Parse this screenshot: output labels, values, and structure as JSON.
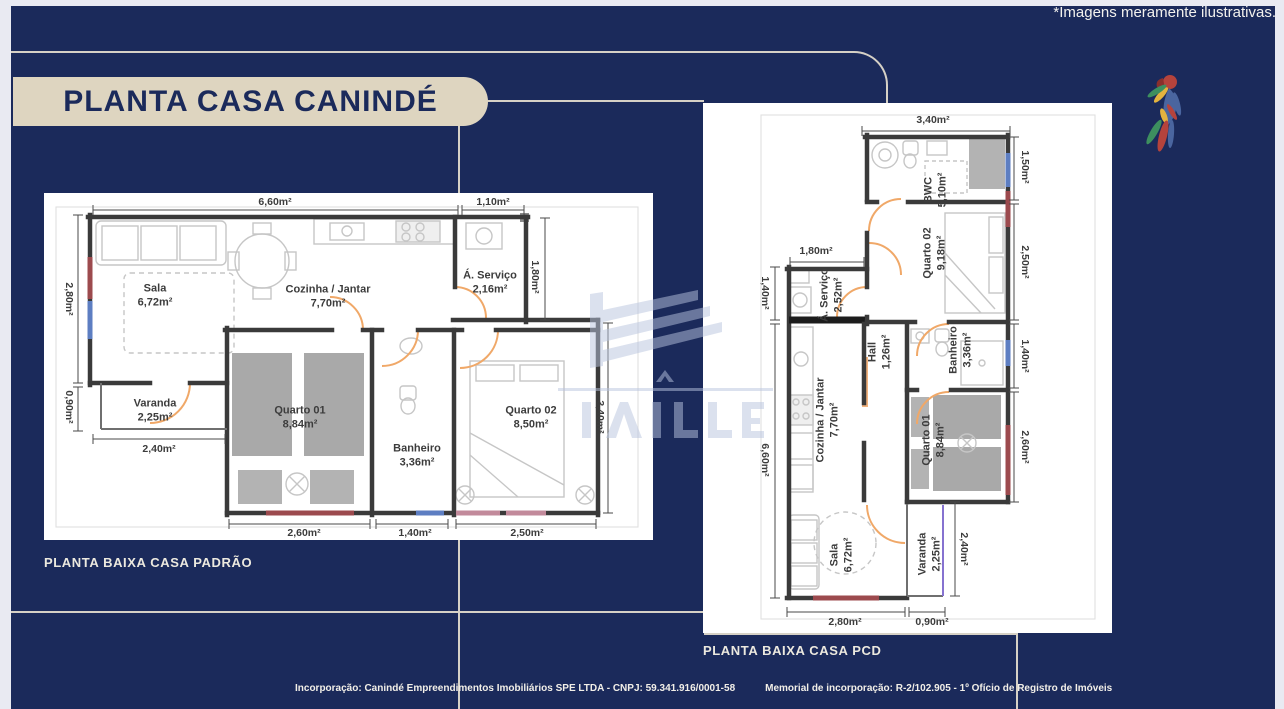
{
  "page": {
    "disclaimer": "*Imagens meramente ilustrativas."
  },
  "header": {
    "title": "PLANTA CASA CANINDÉ"
  },
  "plans": {
    "padrao": {
      "caption": "PLANTA BAIXA CASA PADRÃO",
      "rooms": {
        "sala": {
          "name": "Sala",
          "area": "6,72m²"
        },
        "cozinha": {
          "name": "Cozinha / Jantar",
          "area": "7,70m²"
        },
        "servico": {
          "name": "Á. Serviço",
          "area": "2,16m²"
        },
        "varanda": {
          "name": "Varanda",
          "area": "2,25m²"
        },
        "quarto01": {
          "name": "Quarto 01",
          "area": "8,84m²"
        },
        "banheiro": {
          "name": "Banheiro",
          "area": "3,36m²"
        },
        "quarto02": {
          "name": "Quarto 02",
          "area": "8,50m²"
        }
      },
      "dims": {
        "top_main": "6,60m²",
        "top_servico": "1,10m²",
        "left_sala": "2,80m²",
        "left_varanda": "0,90m²",
        "servico_height": "1,80m²",
        "right_height": "3,40m²",
        "varanda_width": "2,40m²",
        "bottom_quarto01": "2,60m²",
        "bottom_banheiro": "1,40m²",
        "bottom_quarto02": "2,50m²"
      }
    },
    "pcd": {
      "caption": "PLANTA BAIXA CASA PCD",
      "rooms": {
        "bwc": {
          "name": "BWC",
          "area": "5,10m²"
        },
        "quarto02": {
          "name": "Quarto 02",
          "area": "9,18m²"
        },
        "servico": {
          "name": "Á. Serviço",
          "area": "2,52m²"
        },
        "hall": {
          "name": "Hall",
          "area": "1,26m²"
        },
        "banheiro": {
          "name": "Banheiro",
          "area": "3,36m²"
        },
        "cozinha": {
          "name": "Cozinha / Jantar",
          "area": "7,70m²"
        },
        "quarto01": {
          "name": "Quarto 01",
          "area": "8,84m²"
        },
        "sala": {
          "name": "Sala",
          "area": "6,72m²"
        },
        "varanda": {
          "name": "Varanda",
          "area": "2,25m²"
        }
      },
      "dims": {
        "top": "3,40m²",
        "right_bwc": "1,50m²",
        "right_quarto02": "2,50m²",
        "right_banheiro": "1,40m²",
        "right_quarto01": "2,60m²",
        "left_servico_w": "1,80m²",
        "left_servico_h": "1,40m²",
        "left_main": "6,60m²",
        "varanda_height": "2,40m²",
        "bottom_sala": "2,80m²",
        "bottom_varanda": "0,90m²"
      }
    }
  },
  "footer": {
    "incorporacao": "Incorporação: Canindé Empreendimentos Imobiliários SPE LTDA - CNPJ: 59.341.916/0001-58",
    "memorial": "Memorial de incorporação: R-2/102.905 - 1º Ofício de Registro de Imóveis"
  },
  "icons": {
    "parrot": "parrot-logo",
    "watermark": "builder-watermark"
  },
  "colors": {
    "slide_bg": "#1b2a5b",
    "badge_bg": "#ded5c0",
    "frame_line": "#d6d1c6",
    "wall": "#3a3a3a",
    "door_arc": "#f0a868",
    "window_blue": "#5d7ec2",
    "window_red": "#9c4a4e",
    "varanda_line": "#8672d0"
  }
}
